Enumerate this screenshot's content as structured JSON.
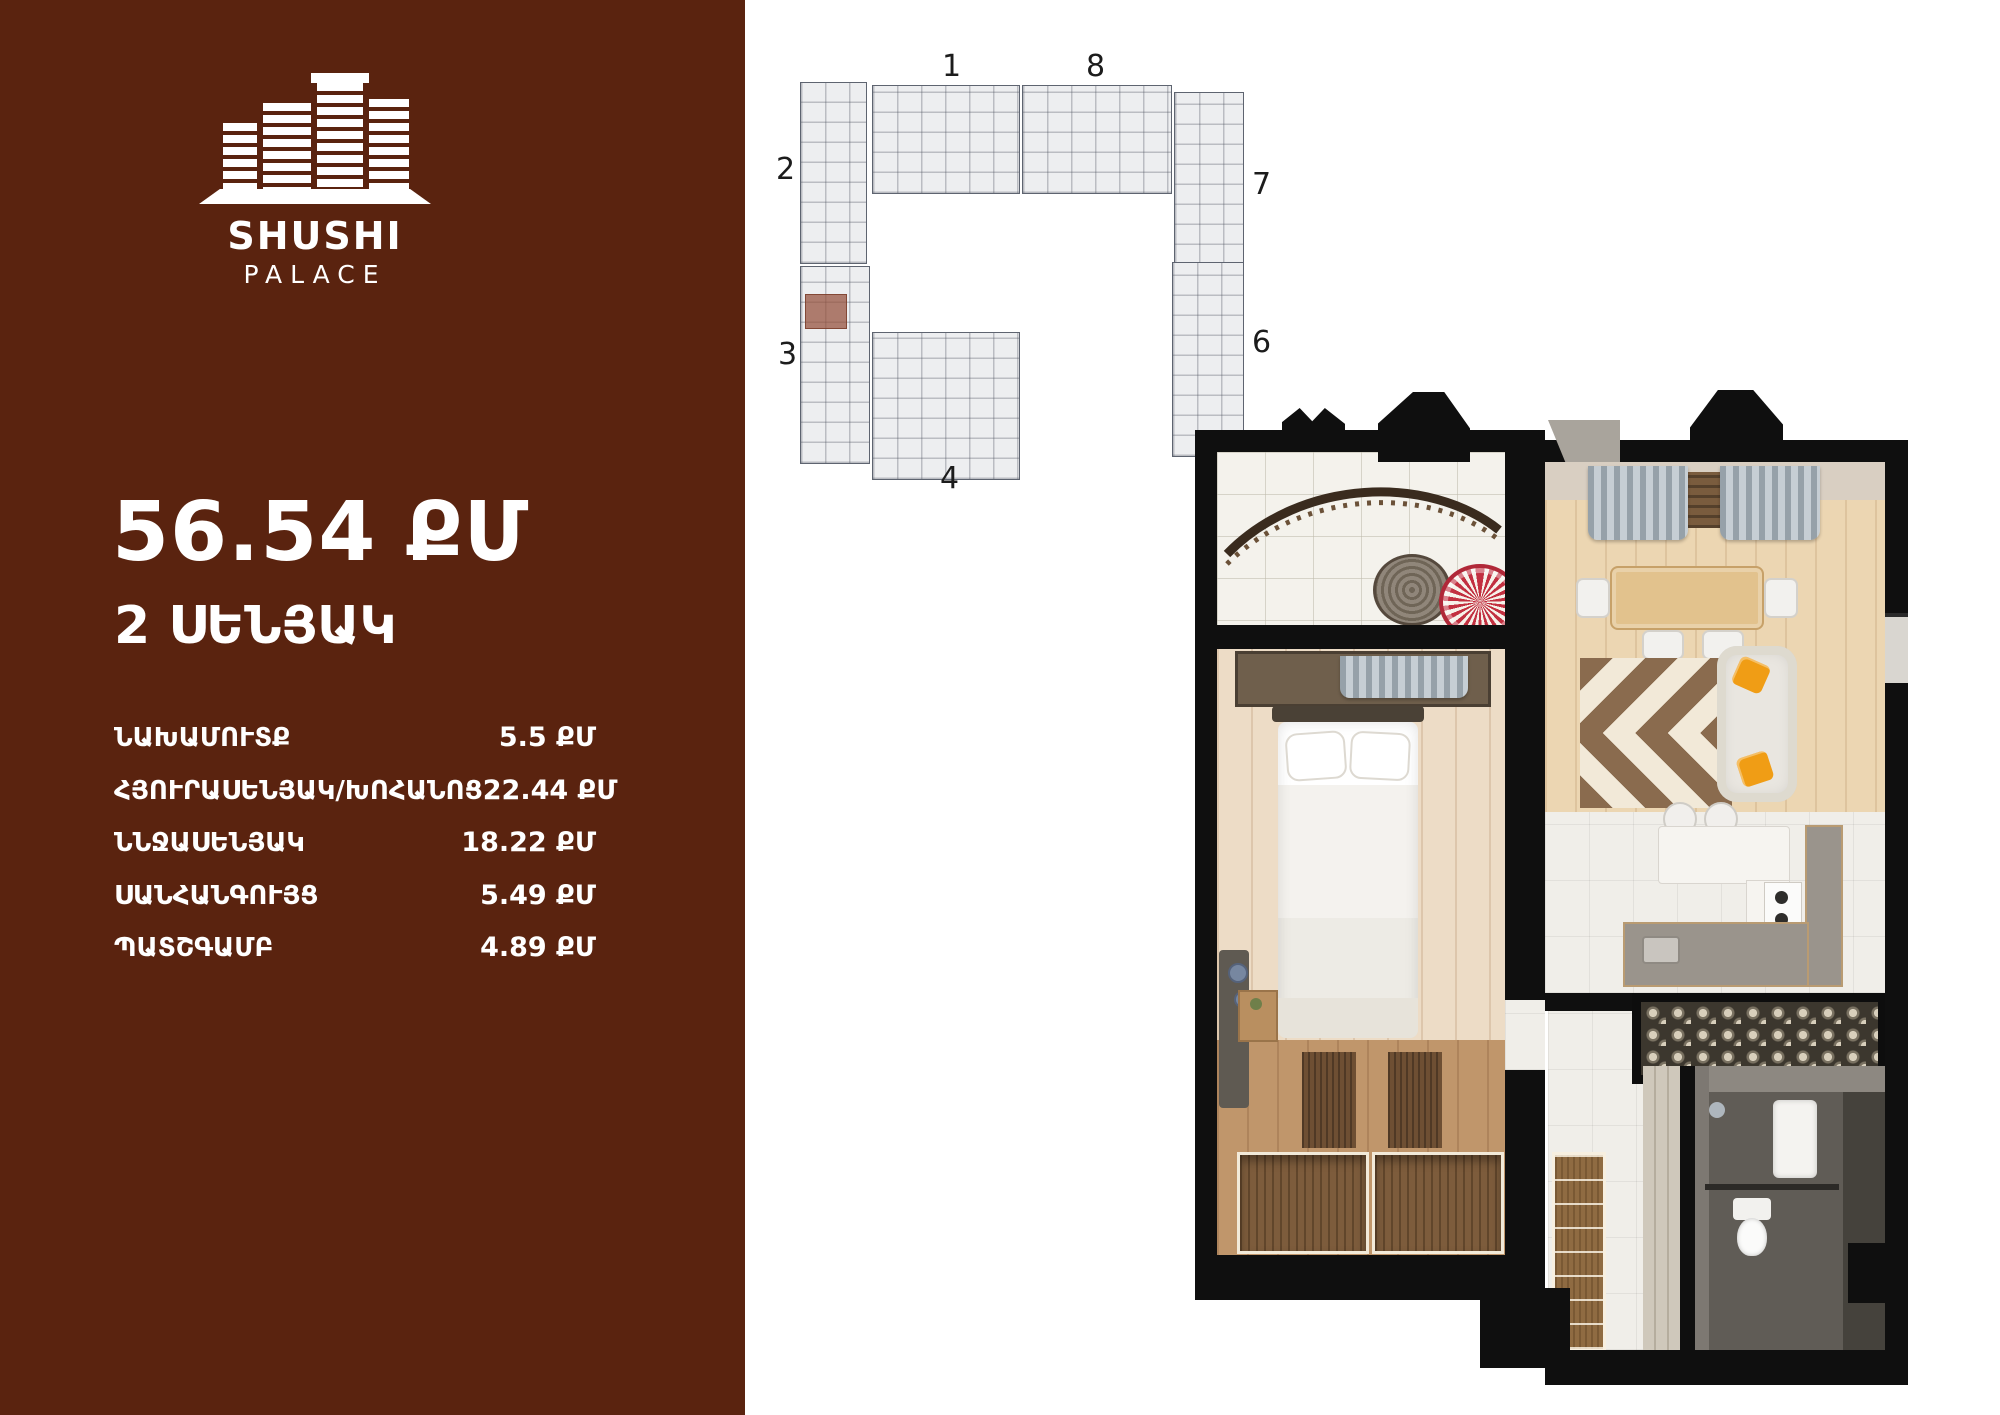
{
  "brand": {
    "name": "SHUSHI",
    "subname": "PALACE"
  },
  "listing": {
    "total_area": "56.54 ՔՄ",
    "rooms_label": "2 ՍԵՆՅԱԿ"
  },
  "room_table": [
    {
      "label": "ՆԱԽԱՄՈՒՏՔ",
      "area": "5.5 ՔՄ"
    },
    {
      "label": "ՀՅՈՒՐԱՍԵՆՅԱԿ/ԽՈՀԱՆՈՑ",
      "area": "22.44 ՔՄ"
    },
    {
      "label": "ՆՆՋԱՍԵՆՅԱԿ",
      "area": "18.22 ՔՄ"
    },
    {
      "label": "ՍԱՆՀԱՆԳՈՒՅՑ",
      "area": "5.49 ՔՄ"
    },
    {
      "label": "ՊԱՏՇԳԱՄԲ",
      "area": "4.89 ՔՄ"
    }
  ],
  "site_plan": {
    "labels": [
      "1",
      "8",
      "2",
      "7",
      "3",
      "6",
      "4"
    ]
  },
  "colors": {
    "sidebar_bg": "#5A230F",
    "unit_highlight": "#944F3A",
    "walls": "#0F0F0F",
    "pillow_accent": "#F09D15",
    "rug_brown": "#8A6B4E",
    "curtain_gray": "#A9B2B9"
  }
}
